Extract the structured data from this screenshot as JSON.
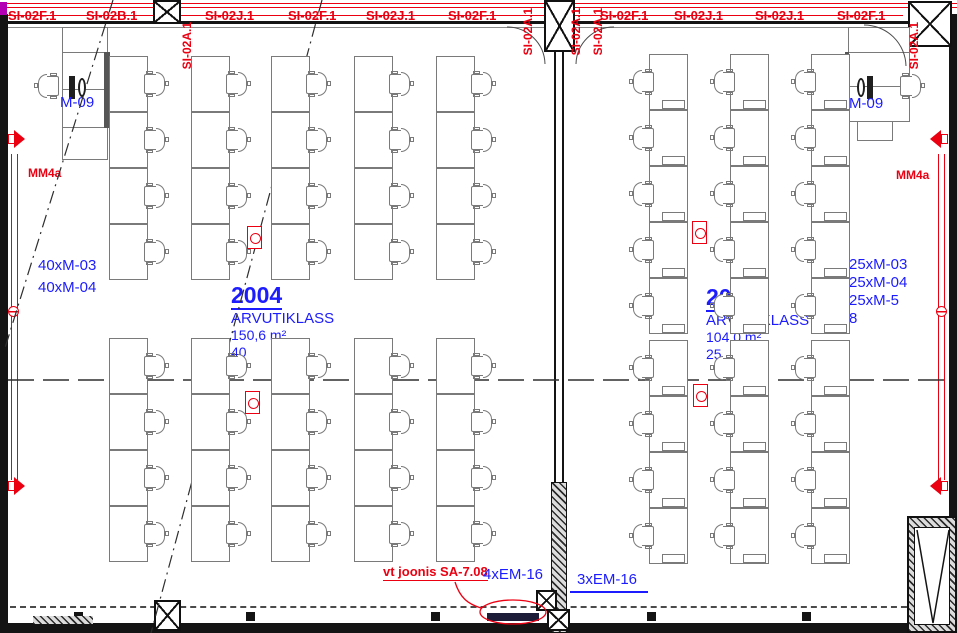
{
  "plan": {
    "rooms": [
      {
        "number": "2004",
        "name": "ARVUTIKLASS",
        "area": "150,6 m²",
        "workstations": "40",
        "teacher_station": "M-09",
        "equipment": [
          "40xM-03",
          "40xM-04"
        ]
      },
      {
        "number": "2005",
        "name": "ARVUTIKLASS",
        "area": "104,0 m²",
        "workstations": "25",
        "teacher_station": "M-09",
        "equipment": [
          "25xM-03",
          "25xM-04",
          "25xM-5",
          "8"
        ]
      }
    ],
    "wall_labels_top": [
      {
        "text": "SI-02F.1",
        "x": 8
      },
      {
        "text": "SI-02B.1",
        "x": 86
      },
      {
        "text": "SI-02J.1",
        "x": 205
      },
      {
        "text": "SI-02F.1",
        "x": 288
      },
      {
        "text": "SI-02J.1",
        "x": 366
      },
      {
        "text": "SI-02F.1",
        "x": 448
      },
      {
        "text": "SI-02F.1",
        "x": 600
      },
      {
        "text": "SI-02J.1",
        "x": 674
      },
      {
        "text": "SI-02J.1",
        "x": 755
      },
      {
        "text": "SI-02F.1",
        "x": 837
      }
    ],
    "wall_labels_vertical": [
      {
        "text": "SI-02A.1",
        "x": 180,
        "y": 22
      },
      {
        "text": "SI-02A.1",
        "x": 521,
        "y": 8
      },
      {
        "text": "SI-02A.1",
        "x": 569,
        "y": 8
      },
      {
        "text": "SI-02A.1",
        "x": 591,
        "y": 8
      },
      {
        "text": "SI-02A.1",
        "x": 907,
        "y": 22
      }
    ],
    "annotations": {
      "mm4a": "MM4a",
      "reference_note": "vt joonis SA-7.08",
      "floorbox_left": "4xEM-16",
      "floorbox_right": "3xEM-16"
    }
  },
  "colors": {
    "red": "#eb0012",
    "blue": "#1c1cff",
    "wall": "#141414",
    "furniture": "#7a7a7a"
  },
  "furniture": {
    "desk": {
      "w": 39,
      "h": 56
    },
    "left_room": {
      "chair_side": "right",
      "pc": false,
      "cols_x": [
        109,
        191,
        271,
        354,
        436
      ],
      "rows_y": [
        56,
        112,
        168,
        224,
        338,
        394,
        450,
        506
      ]
    },
    "right_room": {
      "chair_side": "left",
      "pc": true,
      "cols_x": [
        649,
        730,
        811
      ],
      "rows_y": [
        54,
        110,
        166,
        222,
        278,
        340,
        396,
        452,
        508
      ]
    },
    "red_devices": [
      {
        "x": 247,
        "y": 226
      },
      {
        "x": 245,
        "y": 391
      },
      {
        "x": 692,
        "y": 221
      },
      {
        "x": 693,
        "y": 384
      }
    ]
  }
}
